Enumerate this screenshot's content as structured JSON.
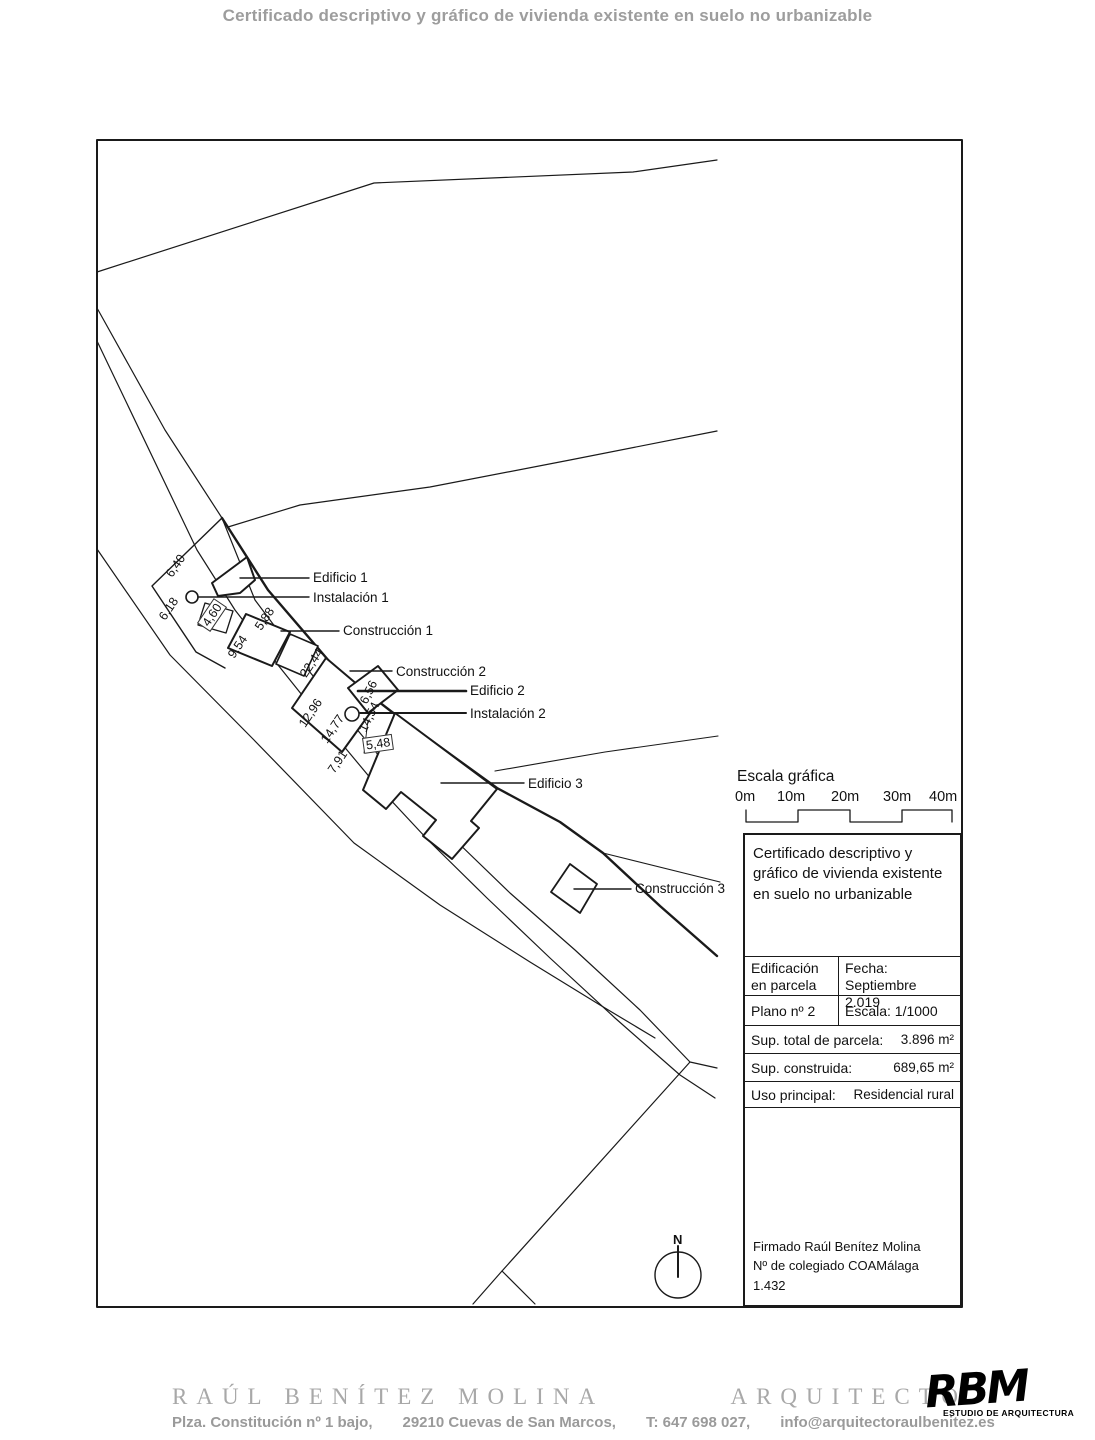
{
  "header": {
    "title": "Certificado descriptivo y gráfico de vivienda existente en suelo no urbanizable"
  },
  "plan": {
    "labels": [
      {
        "text": "Edificio 1"
      },
      {
        "text": "Instalación 1"
      },
      {
        "text": "Construcción 1"
      },
      {
        "text": "Construcción 2"
      },
      {
        "text": "Edificio 2"
      },
      {
        "text": "Instalación 2"
      },
      {
        "text": "Edificio 3"
      },
      {
        "text": "Construcción 3"
      }
    ],
    "dimensions": [
      {
        "text": "6,40"
      },
      {
        "text": "6,18"
      },
      {
        "text": "4,60"
      },
      {
        "text": "5,88"
      },
      {
        "text": "9,54"
      },
      {
        "text": "22,44"
      },
      {
        "text": "12,96"
      },
      {
        "text": "14,77"
      },
      {
        "text": "14,54"
      },
      {
        "text": "6,56"
      },
      {
        "text": "5,48"
      },
      {
        "text": "7,91"
      }
    ],
    "north_label": "N"
  },
  "scale_bar": {
    "title": "Escala gráfica",
    "ticks": [
      {
        "t": "0m"
      },
      {
        "t": "10m"
      },
      {
        "t": "20m"
      },
      {
        "t": "30m"
      },
      {
        "t": "40m"
      }
    ]
  },
  "title_block": {
    "title": "Certificado descriptivo y gráfico de vivienda existente en suelo no urbanizable",
    "cell_1a": "Edificación en parcela",
    "cell_1b_label": "Fecha:",
    "cell_1b_value": "Septiembre 2.019",
    "cell_2a": "Plano nº 2",
    "cell_2b": "Escala: 1/1000",
    "row3_label": "Sup. total de parcela:",
    "row3_value": "3.896 m²",
    "row4_label": "Sup. construida:",
    "row4_value": "689,65 m²",
    "row5_label": "Uso principal:",
    "row5_value": "Residencial rural",
    "signature_line1": "Firmado Raúl Benítez Molina",
    "signature_line2": "Nº de colegiado COAMálaga 1.432"
  },
  "footer": {
    "name": "RAÚL BENÍTEZ MOLINA",
    "profession": "ARQUITECTO",
    "address": "Plza. Constitución nº 1 bajo,",
    "city": "29210 Cuevas de San Marcos,",
    "phone": "T: 647 698 027,",
    "email": "info@arquitectoraulbenitez.es",
    "logo_text": "RBM",
    "logo_subtitle": "ESTUDIO DE ARQUITECTURA"
  },
  "colors": {
    "line": "#1a1a1a",
    "muted_text": "#9d9d9d",
    "footer_serif": "#a8a8a8"
  }
}
